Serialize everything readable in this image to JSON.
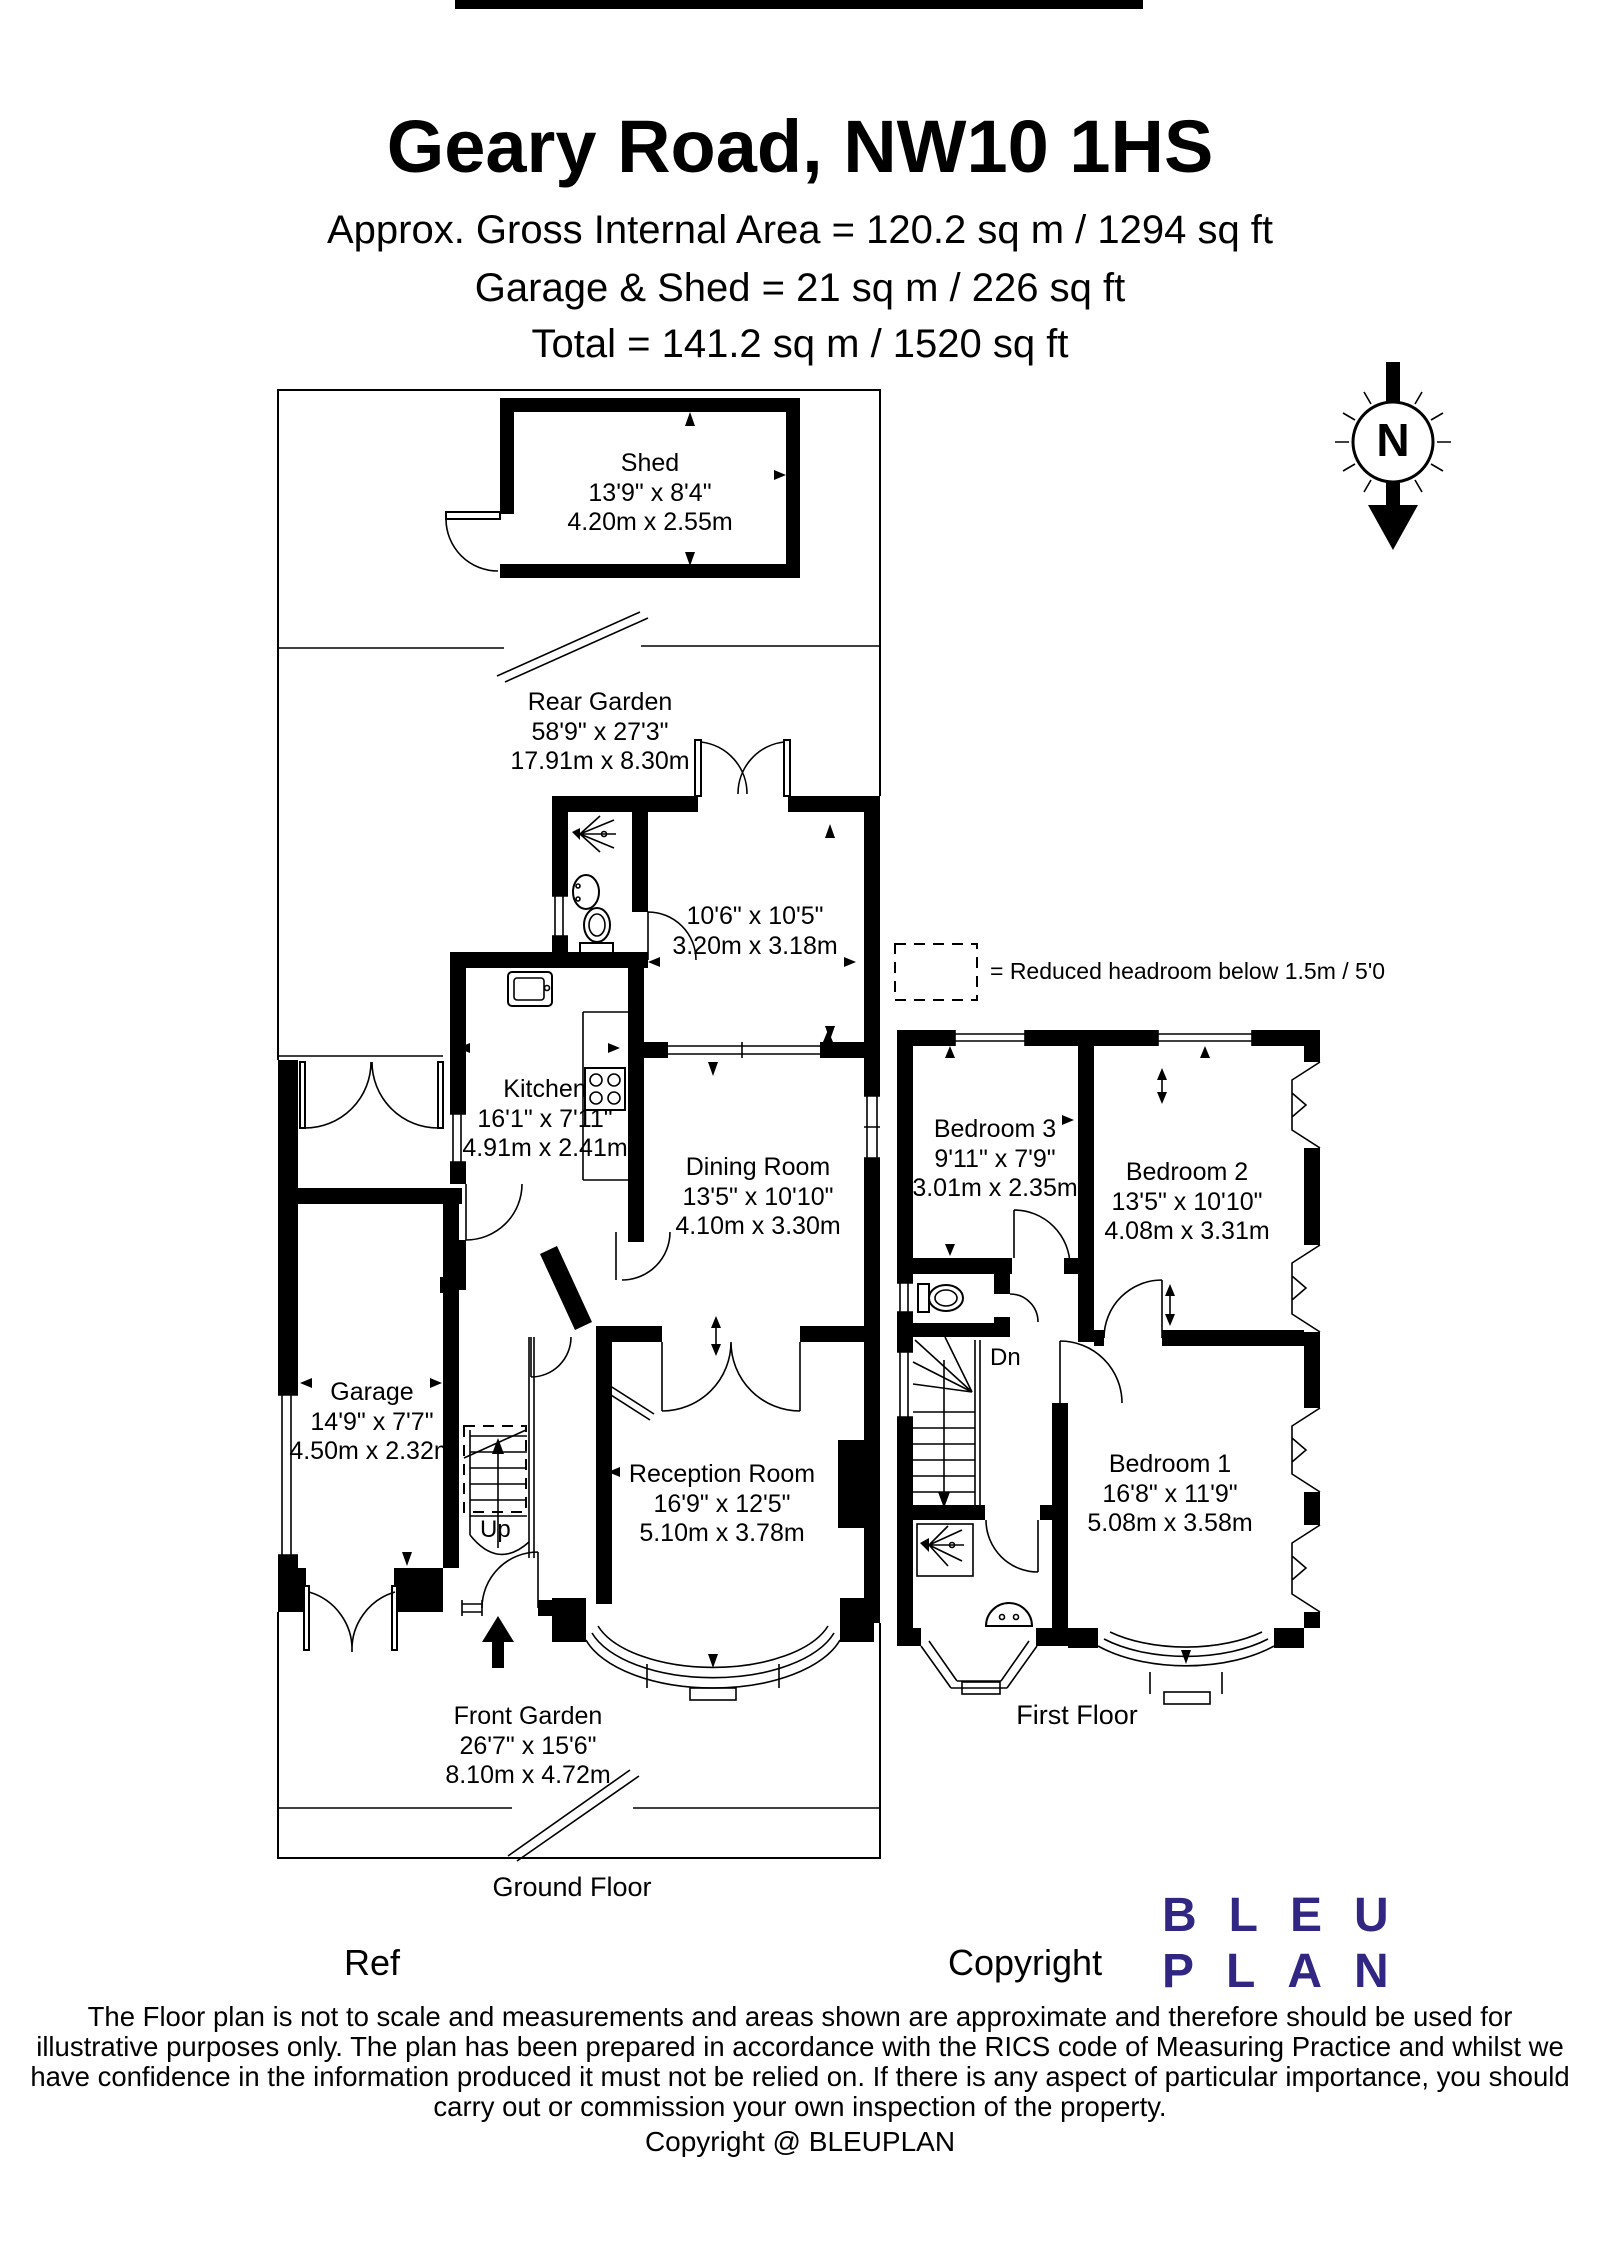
{
  "header": {
    "title": "Geary Road, NW10 1HS",
    "area_line": "Approx. Gross Internal Area = 120.2 sq m / 1294 sq ft",
    "garage_shed_line": "Garage & Shed = 21 sq m / 226 sq ft",
    "total_line": "Total = 141.2 sq m / 1520 sq ft"
  },
  "compass": {
    "north_label": "N"
  },
  "legend": {
    "reduced_headroom": "= Reduced headroom below 1.5m / 5'0"
  },
  "ground_floor": {
    "label": "Ground Floor",
    "shed": {
      "name": "Shed",
      "imperial": "13'9\" x 8'4\"",
      "metric": "4.20m x 2.55m"
    },
    "rear_garden": {
      "name": "Rear Garden",
      "imperial": "58'9\" x 27'3\"",
      "metric": "17.91m x 8.30m"
    },
    "rear_reception": {
      "imperial": "10'6\" x 10'5\"",
      "metric": "3.20m x 3.18m"
    },
    "kitchen": {
      "name": "Kitchen",
      "imperial": "16'1\" x 7'11\"",
      "metric": "4.91m x 2.41m"
    },
    "dining_room": {
      "name": "Dining Room",
      "imperial": "13'5\" x 10'10\"",
      "metric": "4.10m x 3.30m"
    },
    "garage": {
      "name": "Garage",
      "imperial": "14'9\" x 7'7\"",
      "metric": "4.50m x 2.32m"
    },
    "reception_room": {
      "name": "Reception Room",
      "imperial": "16'9\" x 12'5\"",
      "metric": "5.10m x 3.78m"
    },
    "front_garden": {
      "name": "Front Garden",
      "imperial": "26'7\" x 15'6\"",
      "metric": "8.10m x 4.72m"
    },
    "stairs_label": "Up"
  },
  "first_floor": {
    "label": "First Floor",
    "bedroom_3": {
      "name": "Bedroom 3",
      "imperial": "9'11\" x 7'9\"",
      "metric": "3.01m x 2.35m"
    },
    "bedroom_2": {
      "name": "Bedroom 2",
      "imperial": "13'5\" x 10'10\"",
      "metric": "4.08m x 3.31m"
    },
    "bedroom_1": {
      "name": "Bedroom 1",
      "imperial": "16'8\" x 11'9\"",
      "metric": "5.08m x 3.58m"
    },
    "stairs_label": "Dn"
  },
  "footer": {
    "ref_label": "Ref",
    "copyright_label": "Copyright",
    "logo": {
      "line1": "BLEU",
      "line2": "PLAN",
      "color": "#312783"
    },
    "disclaimer": "The Floor plan is not to scale and measurements and areas shown are approximate and therefore should be used for illustrative purposes only. The plan has been prepared in accordance with the RICS code of Measuring Practice and whilst we have confidence in the information produced it must not be relied on. If there is any aspect of particular importance, you should carry out or commission your own inspection of the property.",
    "copyright_note": "Copyright @ BLEUPLAN"
  }
}
